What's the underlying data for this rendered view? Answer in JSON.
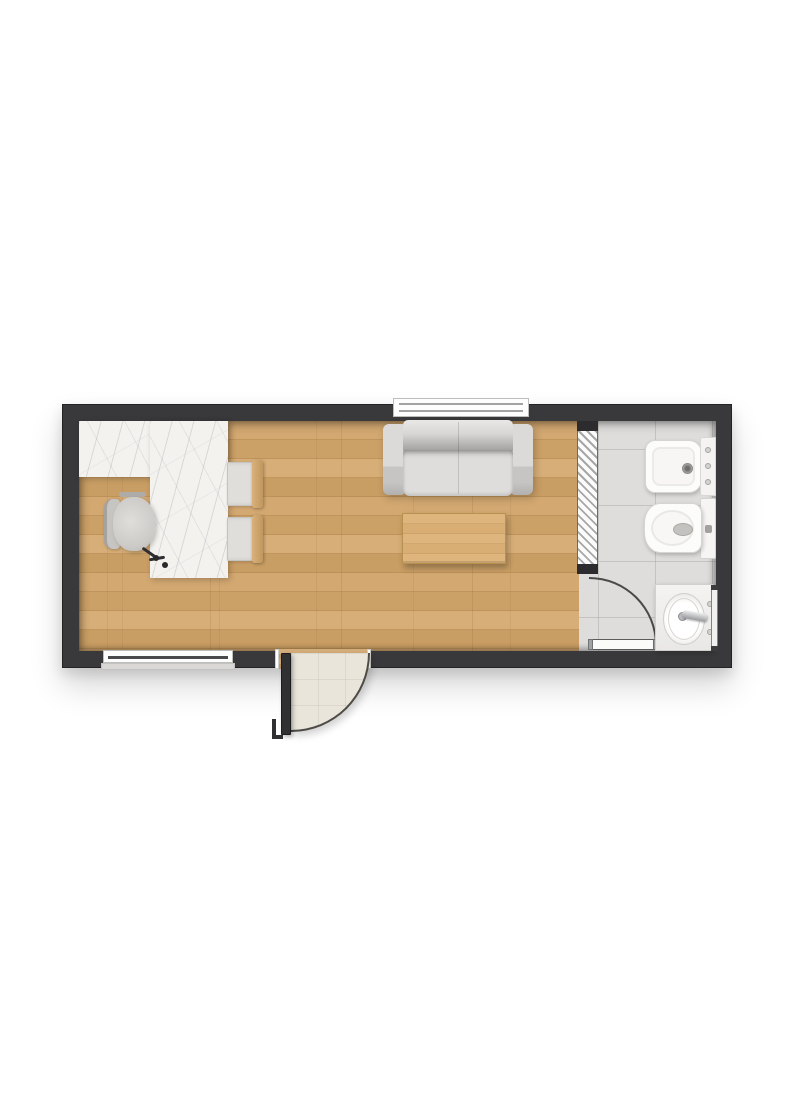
{
  "scene": {
    "type": "architectural floor plan rendering",
    "view": "top-down",
    "visible_text": "none"
  },
  "palette": {
    "background": "#ffffff",
    "exterior_wall": "#39393b",
    "wall_outline": "#232325",
    "wood_floor": "#cca267",
    "wood_furniture": "#d2a86f",
    "marble_counter": "#f3f2ef",
    "bathroom_tile": "#dedddb",
    "entry_porch_tile": "#e9e5da",
    "fixture_white": "#fcfcfb",
    "sofa_gray": "#d8d7d5",
    "chrome": "#9fa1a3",
    "door_leaf_dark": "#303032"
  },
  "rooms": [
    {
      "name": "main room",
      "floor": "light oak plank",
      "furniture": [
        "L-shaped marble counter/desk",
        "office chair",
        "counter chair",
        "counter chair",
        "two-seat sofa",
        "wooden coffee table"
      ]
    },
    {
      "name": "bathroom",
      "floor": "gray ceramic tile",
      "fixtures": [
        "bidet with wall deck and knobs",
        "toilet with tank",
        "vanity with oval washbasin and faucet",
        "wall mirror panel"
      ]
    }
  ],
  "openings": {
    "windows": [
      {
        "location": "top wall, behind sofa"
      },
      {
        "location": "bottom wall, left segment"
      }
    ],
    "doors": [
      {
        "location": "bottom wall, entry",
        "swing": "outward quarter-circle onto porch tile"
      },
      {
        "location": "hatched partition to bathroom",
        "swing": "into bathroom quarter-arc"
      }
    ],
    "partition": {
      "style": "diagonal-hatched stud wall with dark end caps"
    }
  },
  "labels": {
    "plan": "Studio unit floor plan",
    "wood_floor": "Wood plank floor",
    "tile_floor": "Bathroom tile floor",
    "partition": "Hatched partition wall",
    "window_top": "Window (top wall)",
    "window_bottom": "Window (bottom wall)",
    "entry_door": "Entry door leaf",
    "entry_swing": "Entry door swing",
    "bath_door": "Bathroom door leaf",
    "bath_arc": "Bathroom door swing arc",
    "counter": "Marble counter / desk",
    "office_chair": "Office chair",
    "counter_chair_1": "Counter chair 1",
    "counter_chair_2": "Counter chair 2",
    "sofa": "Two-seat sofa",
    "coffee_table": "Coffee table",
    "bidet": "Bidet",
    "toilet": "Toilet",
    "vanity": "Washbasin vanity",
    "mirror": "Mirror panel"
  }
}
